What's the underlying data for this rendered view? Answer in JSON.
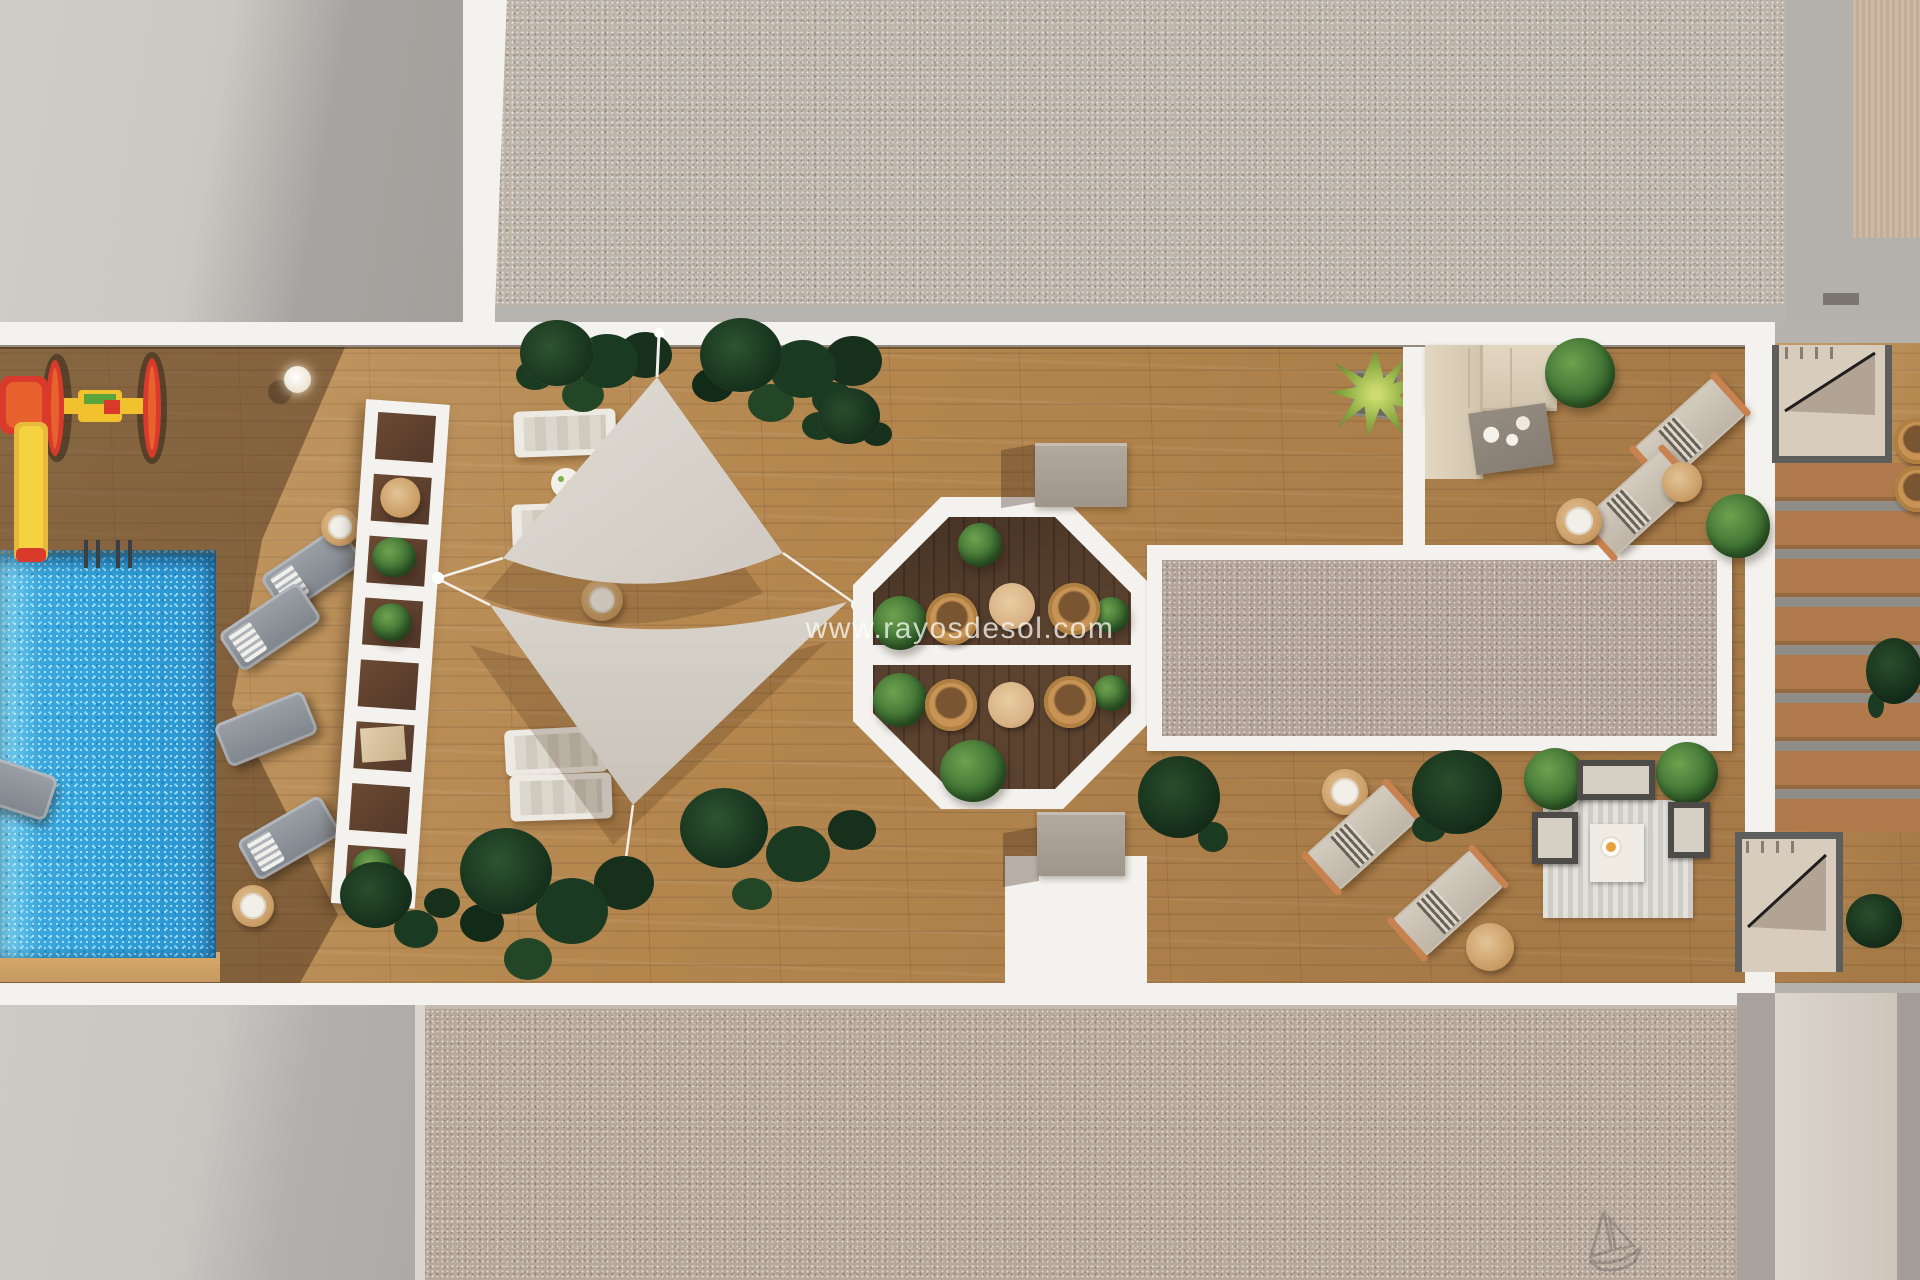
{
  "watermark": {
    "text": "www.rayosdesol.com"
  },
  "bottom_glyph": {
    "name": "sailboat-sketch-icon"
  },
  "colors": {
    "wood_sun": "#b5874f",
    "wood_shade": "#7a5233",
    "wood_dark": "#5c4330",
    "white": "#f4f2ee",
    "gravel_top": "#beb5aa",
    "gravel_bottom": "#b7a89b",
    "gravel_mid": "#b2a498",
    "gray_light": "#cdc9c4",
    "gray_shadow": "#a4a09d",
    "pool": "#2f9fd8",
    "sail": "#d8d3cb",
    "cream_sofa": "#ddd1bb",
    "lounger_gray": "#8a9097",
    "lounger_greige": "#cbc3b5",
    "wood_accent": "#c8824f",
    "plant_dark": "#1d3a24",
    "plant_bright": "#4e7d3a",
    "yucca": "#8fae45",
    "charcoal": "#4c4b48",
    "steps_gray": "#908d89",
    "playground_red": "#d93a2b",
    "playground_yellow": "#f2c12e"
  }
}
